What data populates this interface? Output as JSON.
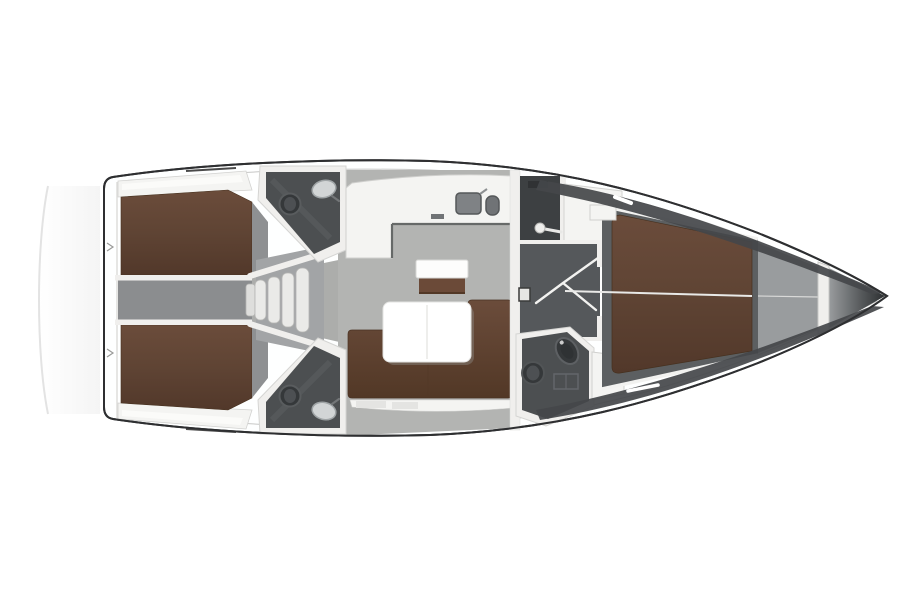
{
  "figure": {
    "kind": "yacht-floor-plan-top-view",
    "rooms": [
      "aft-cabin-port",
      "aft-cabin-starboard",
      "engine-compartment",
      "companionway-steps",
      "aft-head-port",
      "aft-head-starboard",
      "salon",
      "galley",
      "dinette-table",
      "u-sofa",
      "chart-seat",
      "shower-room",
      "corridor",
      "forward-head",
      "forward-cabin",
      "anchor-locker",
      "bow"
    ],
    "fixtures": [
      "toilet",
      "washbasin",
      "double-sink",
      "shower-head",
      "door-swing",
      "bed",
      "table",
      "steps"
    ]
  },
  "palette": {
    "background": "#ffffff",
    "hull_outline": "#2e2f31",
    "hull_fill": "#feffff",
    "deck_white": "#f4f4f2",
    "wall_white": "#f0efed",
    "shelf_highlight": "#fbfbf9",
    "bed_brown": "#5f4434",
    "bed_brown_light": "#6b4c3b",
    "bed_brown_dark": "#52382a",
    "sofa_brown": "#6b4a38",
    "sofa_brown_dark": "#523826",
    "salon_floor": "#b3b4b2",
    "passage_floor": "#acadab",
    "cabin_floor": "#8e9092",
    "engine_floor": "#8b8d8f",
    "corridor_floor": "#55585b",
    "head_floor": "#4c4f51",
    "shower_floor": "#3d4042",
    "fwd_floor": "#5c5f61",
    "locker_gray": "#999c9e",
    "bow_dark": "#2c2f31",
    "hull_band_dark": "#44474a",
    "step_white": "#eaeae8",
    "steps_back": "#a2a4a6",
    "table_white": "#ffffff",
    "table_shadow": "#9c9d9b",
    "counter_edge": "#666968",
    "sink_gray": "#7f8285",
    "sink_gray_dark": "#707376",
    "fixture_light": "#d2d5d6",
    "fixture_dark": "#35383a",
    "fixture_mid": "#4d5053",
    "seam_white": "#e9e9e7",
    "line_gray": "#a9a9a7",
    "shadow_arc": "#e3e3e3",
    "detail_dark": "#303234",
    "panel_fill": "#e6e6e4"
  }
}
